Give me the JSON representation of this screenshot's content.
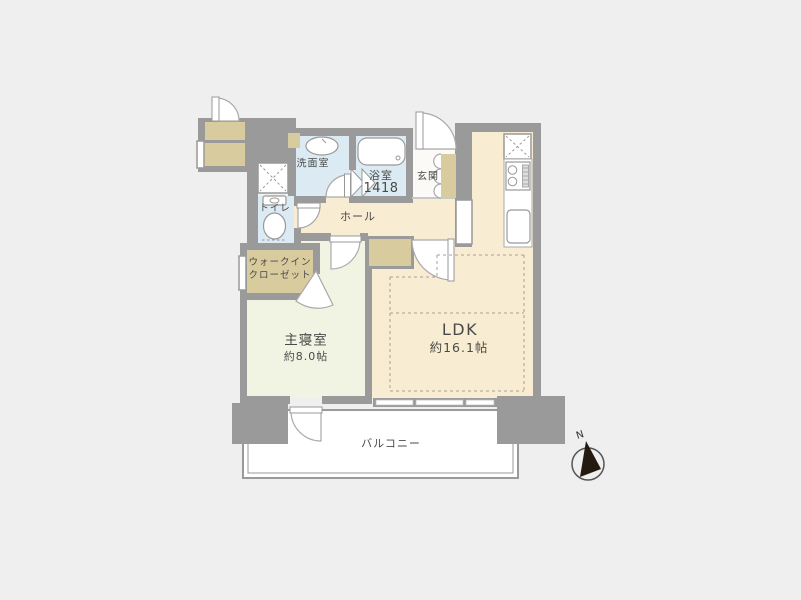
{
  "plan": {
    "rooms": {
      "ldk": {
        "label": "LDK",
        "size": "約16.1帖"
      },
      "bedroom": {
        "label": "主寝室",
        "size": "約8.0帖"
      },
      "hall": {
        "label": "ホール"
      },
      "entrance": {
        "label": "玄関"
      },
      "washroom": {
        "label": "洗面室"
      },
      "bathroom": {
        "label": "浴室",
        "size": "1418"
      },
      "toilet": {
        "label": "トイレ"
      },
      "walk_in_closet": {
        "line1": "ウォークイン",
        "line2": "クローゼット"
      },
      "balcony": {
        "label": "バルコニー"
      }
    },
    "compass": {
      "label": "N"
    },
    "colors": {
      "wall": "#9a9a9a",
      "floor_cream": "#f8ecd2",
      "floor_bedroom": "#f1f3e3",
      "floor_wet": "#dcebf3",
      "closet_tan": "#d8cb9d",
      "balcony": "#ffffff",
      "background": "#efefef",
      "text": "#4a4a4a",
      "compass_needle": "#241a10"
    }
  }
}
